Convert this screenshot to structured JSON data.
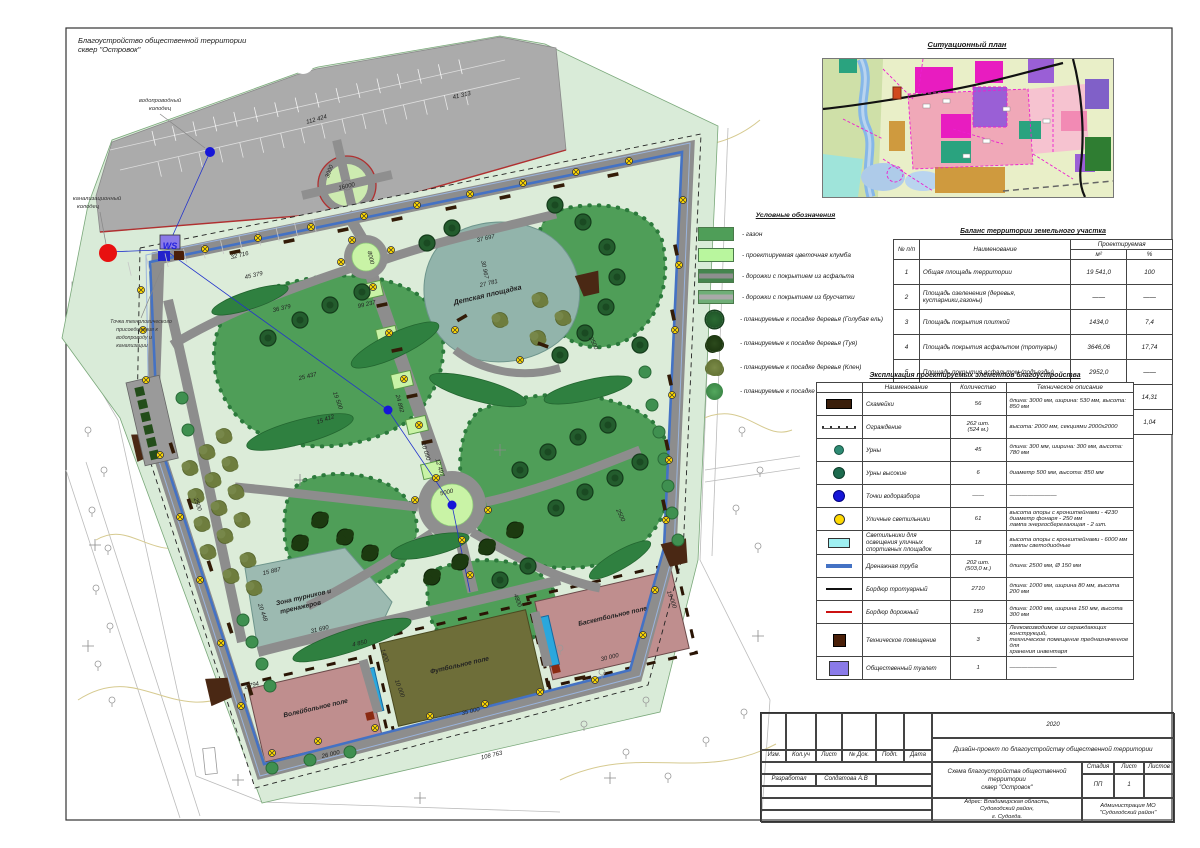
{
  "sheet": {
    "title_line1": "Благоустройство общественной территории",
    "title_line2": "сквер \"Островок\""
  },
  "colors": {
    "mint": "#d9ebd8",
    "lawn": "#4f9e58",
    "flowerbed": "#c9f3a6",
    "path_gray": "#8d8d8d",
    "parking_gray": "#ababab",
    "playground_teal": "#92b4ab",
    "field_pink": "#bf8e8e",
    "football_olive": "#6e6e39",
    "drain_blue": "#4472c4",
    "curb_red": "#c0392b",
    "lamp_yellow": "#ffd900",
    "bench_brown": "#3a1e0a",
    "water_blue": "#1616d8"
  },
  "situational_plan": {
    "title": "Ситуационный план"
  },
  "legend": {
    "title": "Условные обозначения",
    "items": [
      {
        "sym": "sw sw-lawn",
        "tree": false,
        "label": "- газон"
      },
      {
        "sym": "sw sw-flower",
        "tree": false,
        "label": "- проектируемая цветочная клумба"
      },
      {
        "sym": "sw sw-asphalt",
        "tree": false,
        "label": "- дорожки с покрытием из асфальта"
      },
      {
        "sym": "sw sw-paver",
        "tree": false,
        "label": "- дорожки с покрытием из брусчатки"
      },
      {
        "sym": "sw tree sw-spruce",
        "tree": true,
        "label": "- планируемые к посадке деревья (Голубая ель)"
      },
      {
        "sym": "sw tree sw-thuja",
        "tree": true,
        "label": "- планируемые к посадке деревья (Туя)"
      },
      {
        "sym": "sw tree sw-maple1",
        "tree": true,
        "label": "- планируемые к посадке деревья (Клен)"
      },
      {
        "sym": "sw tree sw-maple2",
        "tree": true,
        "label": "- планируемые к посадке деревья (Клен)"
      }
    ]
  },
  "balance_table": {
    "title": "Баланс территории земельного участка",
    "col_num": "№ п/п",
    "col_name": "Наименование",
    "col_group": "Проектируемая",
    "col_m2": "м²",
    "col_pct": "%",
    "rows": [
      {
        "n": "1",
        "name": "Общая площадь территории",
        "m2": "19 541,0",
        "pct": "100"
      },
      {
        "n": "2",
        "name": "Площадь озеленения (деревья, кустарники,газоны)",
        "m2": "——",
        "pct": "——"
      },
      {
        "n": "3",
        "name": "Площадь покрытия плиткой",
        "m2": "1434,0",
        "pct": "7,4"
      },
      {
        "n": "4",
        "name": "Площадь покрытия асфальтом (тротуары)",
        "m2": "3646,06",
        "pct": "17,74"
      },
      {
        "n": "5",
        "name": "Площадь покрытия асфальтом (подъезды)",
        "m2": "2952,0",
        "pct": "——"
      },
      {
        "n": "6",
        "name": "Площадь  резинового покрытия",
        "m2": "2689,99",
        "pct": "14,31"
      },
      {
        "n": "7",
        "name": "Площадь  цветников",
        "m2": "201,82",
        "pct": "1,04"
      }
    ]
  },
  "explication_table": {
    "title": "Экспликация проектируемых элементов благоустройства",
    "col_name": "Наименование",
    "col_qty": "Количество",
    "col_desc": "Техническое описание",
    "rows": [
      {
        "sym": "tsym tsym-bench",
        "symname": "bench-symbol",
        "name": "Скамейки",
        "qty": "56",
        "desc": "длина: 3000 мм, ширина: 530 мм, высота: 850 мм",
        "small": false
      },
      {
        "sym": "tsym tsym-fence",
        "symname": "fence-symbol",
        "name": "Ограждение",
        "qty": "262 шт.\n(524 м.)",
        "desc": "высота: 2000 мм, секциями 2000х2000",
        "small": false
      },
      {
        "sym": "tsym tsym-urn",
        "symname": "urn-symbol",
        "name": "Урны",
        "qty": "45",
        "desc": "длина: 300 мм, ширина: 300 мм, высота: 780 мм",
        "small": false
      },
      {
        "sym": "tsym tsym-urntall",
        "symname": "tall-urn-symbol",
        "name": "Урны высокие",
        "qty": "6",
        "desc": "диаметр 500 мм, высота: 850 мм",
        "small": false
      },
      {
        "sym": "tsym tsym-water",
        "symname": "water-point-symbol",
        "name": "Точки водоразбора",
        "qty": "——",
        "desc": "————————",
        "small": false
      },
      {
        "sym": "tsym tsym-lamp",
        "symname": "street-lamp-symbol",
        "name": "Уличные светильники",
        "qty": "61",
        "desc": "высота опоры с кронштейнами - 4230\nдиаметр фонаря - 250 мм\nлампа энергосберегающая - 2 шт.",
        "small": false
      },
      {
        "sym": "tsym tsym-sportlight",
        "symname": "sport-light-symbol",
        "name": "Светильники для освещения уличных спортивных площадок",
        "qty": "18",
        "desc": "высота опоры с кронштейнами - 6000 мм\nлампы светодиодные",
        "small": false
      },
      {
        "sym": "tsym tsym-drain",
        "symname": "drain-pipe-symbol",
        "name": "Дренажная труба",
        "qty": "202 шт.\n(503,0 м.)",
        "desc": "длина: 2500 мм, Ø 150 мм",
        "small": false
      },
      {
        "sym": "tsym tsym-curb1",
        "symname": "sidewalk-curb-symbol",
        "name": "Бордюр тротуарный",
        "qty": "2710",
        "desc": "длина: 1000 мм, ширина 80 мм, высота 200 мм",
        "small": false
      },
      {
        "sym": "tsym tsym-curb2",
        "symname": "road-curb-symbol",
        "name": "Бордюр дорожный",
        "qty": "159",
        "desc": "длина: 1000 мм, ширина 150 мм, высота 300 мм",
        "small": false
      },
      {
        "sym": "tsym tsym-tech",
        "symname": "tech-room-symbol",
        "name": "Техническое помещение",
        "qty": "3",
        "desc": "Легковозводимое из ограждающих конструкций,\nтехническое помещение предназначенное для\nхранения инвентаря",
        "small": true
      },
      {
        "sym": "tsym tsym-ws",
        "symname": "toilet-symbol",
        "name": "Общественный туалет",
        "qty": "1",
        "desc": "————————",
        "small": false
      }
    ],
    "toilet_symbol_text": "WS"
  },
  "title_block": {
    "year": "2020",
    "project": "Дизайн-проект по благоустройству общественной территории",
    "col_izm": "Изм.",
    "col_kol": "Кол.уч",
    "col_list": "Лист",
    "col_doc": "№ Док.",
    "col_podp": "Подп.",
    "col_data": "Дата",
    "drawing_title": "Схема благоустройства общественной территории\nсквер \"Островок\"",
    "stage_label": "Стадия",
    "sheet_label": "Лист",
    "sheets_label": "Листов",
    "stage": "ПП",
    "sheet_no": "1",
    "developed_label": "Разработал",
    "developer": "Солдатова А.В",
    "address": "Адрес: Владимирская область,\nСудогодский район,\nг. Судогда.",
    "client": "Администрация МО\n\"Судогодский район\""
  },
  "plan": {
    "labels": [
      {
        "t": "Детская площадка",
        "x": 488,
        "y": 297,
        "r": -13,
        "s": 7.2,
        "b": true,
        "c": "#222"
      },
      {
        "t": "Зона турников и",
        "x": 304,
        "y": 599,
        "r": -13,
        "s": 6.6,
        "b": true,
        "c": "#222"
      },
      {
        "t": "тренажеров",
        "x": 301,
        "y": 609,
        "r": -13,
        "s": 6.6,
        "b": true,
        "c": "#222"
      },
      {
        "t": "Волейбольное поле",
        "x": 316,
        "y": 710,
        "r": -13,
        "s": 6.6,
        "b": true,
        "c": "#222"
      },
      {
        "t": "Футбольное поле",
        "x": 460,
        "y": 667,
        "r": -13,
        "s": 6.6,
        "b": true,
        "c": "#222"
      },
      {
        "t": "Баскетбольное поле",
        "x": 613,
        "y": 618,
        "r": -13,
        "s": 6.6,
        "b": true,
        "c": "#222"
      },
      {
        "t": "WS",
        "x": 170,
        "y": 249,
        "r": 0,
        "s": 9,
        "b": true,
        "c": "#2222dd"
      },
      {
        "t": "водопроводный",
        "x": 160,
        "y": 102,
        "r": 0,
        "s": 5.8,
        "b": false,
        "c": "#333"
      },
      {
        "t": "колодец",
        "x": 160,
        "y": 110,
        "r": 0,
        "s": 5.8,
        "b": false,
        "c": "#333"
      },
      {
        "t": "канализационный",
        "x": 97,
        "y": 200,
        "r": 0,
        "s": 5.8,
        "b": false,
        "c": "#333"
      },
      {
        "t": "колодец",
        "x": 88,
        "y": 208,
        "r": 0,
        "s": 5.8,
        "b": false,
        "c": "#333"
      },
      {
        "t": "Точка технологического",
        "x": 141,
        "y": 323,
        "r": 0,
        "s": 5.3,
        "b": false,
        "c": "#333"
      },
      {
        "t": "присоединения к",
        "x": 137,
        "y": 331,
        "r": 0,
        "s": 5.3,
        "b": false,
        "c": "#333"
      },
      {
        "t": "водопроводу и",
        "x": 134,
        "y": 339,
        "r": 0,
        "s": 5.3,
        "b": false,
        "c": "#333"
      },
      {
        "t": "канализации",
        "x": 132,
        "y": 347,
        "r": 0,
        "s": 5.3,
        "b": false,
        "c": "#333"
      }
    ],
    "dimensions": [
      {
        "t": "112 424",
        "x": 317,
        "y": 121,
        "r": -16
      },
      {
        "t": "41 313",
        "x": 462,
        "y": 97,
        "r": -13
      },
      {
        "t": "32 716",
        "x": 240,
        "y": 257,
        "r": -14
      },
      {
        "t": "99 237",
        "x": 367,
        "y": 306,
        "r": -13
      },
      {
        "t": "16000",
        "x": 347,
        "y": 188,
        "r": -13
      },
      {
        "t": "3000",
        "x": 331,
        "y": 172,
        "r": -70
      },
      {
        "t": "8000",
        "x": 369,
        "y": 258,
        "r": 78
      },
      {
        "t": "37 697",
        "x": 486,
        "y": 240,
        "r": -13
      },
      {
        "t": "30 967",
        "x": 483,
        "y": 270,
        "r": 78
      },
      {
        "t": "27 781",
        "x": 489,
        "y": 285,
        "r": -13
      },
      {
        "t": "45 379",
        "x": 254,
        "y": 277,
        "r": -13
      },
      {
        "t": "36 379",
        "x": 282,
        "y": 310,
        "r": -13
      },
      {
        "t": "25 437",
        "x": 308,
        "y": 378,
        "r": -14
      },
      {
        "t": "19 500",
        "x": 336,
        "y": 401,
        "r": 70
      },
      {
        "t": "15 412",
        "x": 326,
        "y": 421,
        "r": -20
      },
      {
        "t": "24 892",
        "x": 398,
        "y": 404,
        "r": 75
      },
      {
        "t": "10 090",
        "x": 424,
        "y": 452,
        "r": 73
      },
      {
        "t": "12 497",
        "x": 438,
        "y": 468,
        "r": 73
      },
      {
        "t": "5000",
        "x": 447,
        "y": 494,
        "r": -13
      },
      {
        "t": "2500",
        "x": 196,
        "y": 505,
        "r": 70
      },
      {
        "t": "2500",
        "x": 592,
        "y": 344,
        "r": 65
      },
      {
        "t": "2500",
        "x": 619,
        "y": 516,
        "r": 65
      },
      {
        "t": "15 887",
        "x": 272,
        "y": 573,
        "r": -13
      },
      {
        "t": "20 448",
        "x": 261,
        "y": 613,
        "r": 70
      },
      {
        "t": "31 690",
        "x": 320,
        "y": 631,
        "r": -13
      },
      {
        "t": "2 794",
        "x": 252,
        "y": 687,
        "r": -14
      },
      {
        "t": "26 000",
        "x": 331,
        "y": 756,
        "r": -13
      },
      {
        "t": "4 850",
        "x": 360,
        "y": 645,
        "r": -13
      },
      {
        "t": "1400",
        "x": 383,
        "y": 656,
        "r": 70
      },
      {
        "t": "10 000",
        "x": 398,
        "y": 689,
        "r": 70
      },
      {
        "t": "35 000",
        "x": 471,
        "y": 713,
        "r": -13
      },
      {
        "t": "4800",
        "x": 516,
        "y": 601,
        "r": 70
      },
      {
        "t": "19 000",
        "x": 670,
        "y": 600,
        "r": 70
      },
      {
        "t": "30 000",
        "x": 610,
        "y": 659,
        "r": -13
      },
      {
        "t": "108 763",
        "x": 492,
        "y": 757,
        "r": -13
      }
    ]
  }
}
